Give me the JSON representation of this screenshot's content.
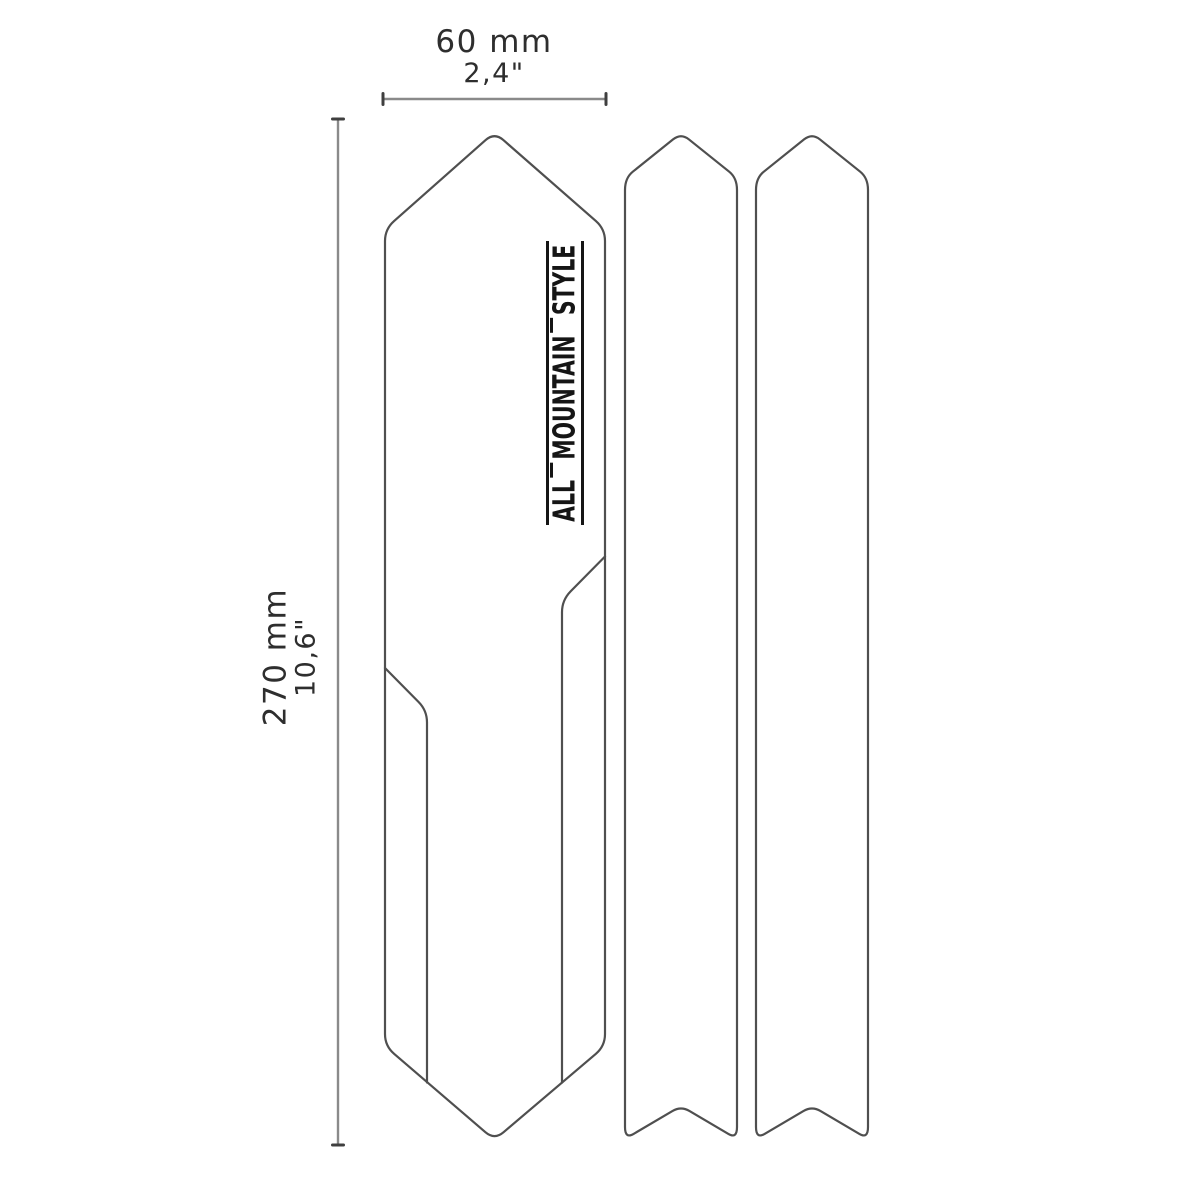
{
  "labels": {
    "width_metric": "60 mm",
    "width_imperial": "2,4\"",
    "height_metric": "270 mm",
    "height_imperial": "10,6\""
  },
  "logo": {
    "words": [
      "ALL",
      "MOUNTAIN",
      "STYLE"
    ],
    "full_text": "ALL MOUNTAIN STYLE"
  },
  "colors": {
    "background": "#ffffff",
    "outline": "#4f4f4f",
    "dimension-line": "#8a8a8a",
    "dimension-tick": "#3f3f3f",
    "label-text": "#2e2e2e",
    "logo-ink": "#151515"
  }
}
